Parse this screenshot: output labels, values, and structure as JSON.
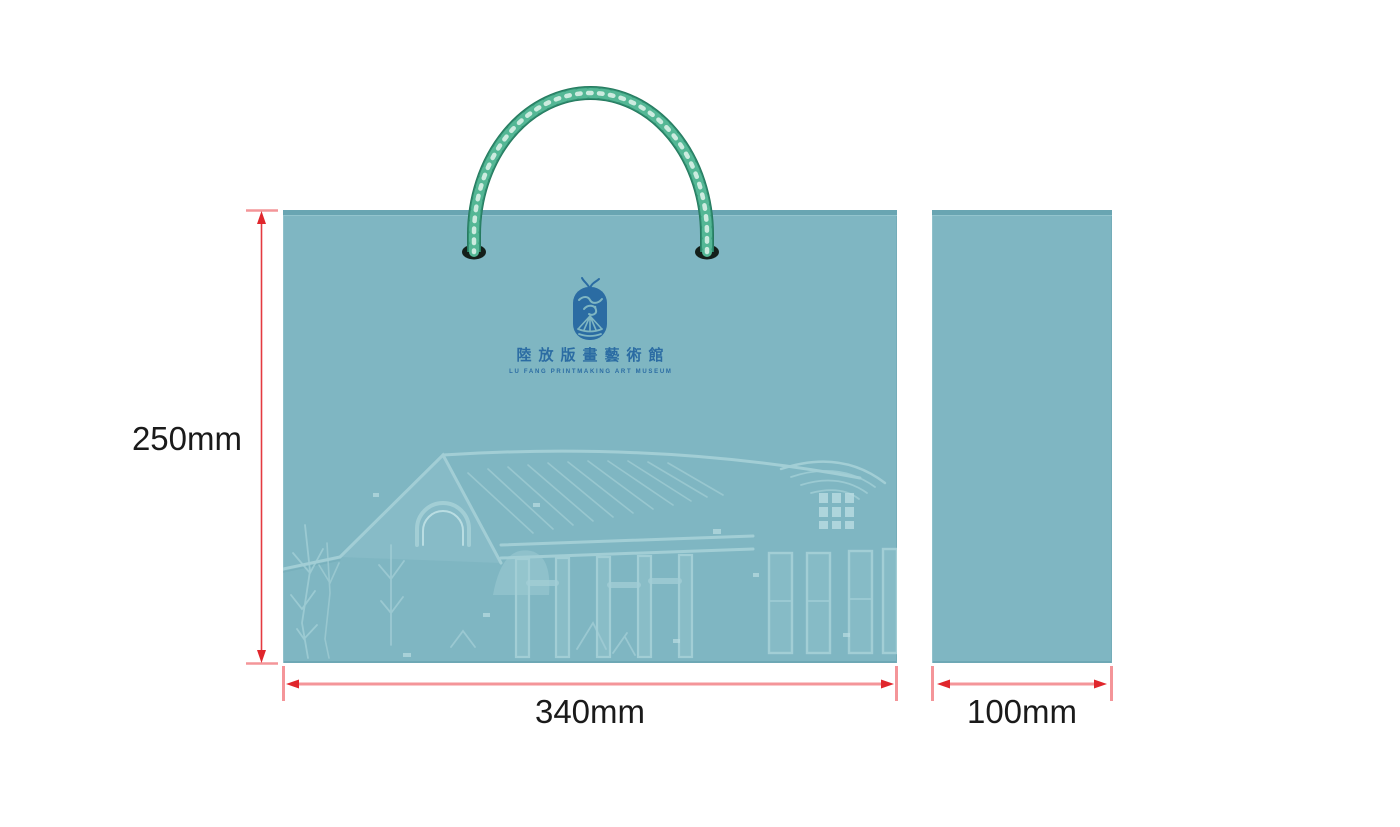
{
  "page": {
    "description": "Paper shopping bag packaging design mockup with dimension annotations",
    "background": "#ffffff"
  },
  "logo": {
    "chinese_name": "陸放版畫藝術館",
    "english_name": "LU FANG PRINTMAKING ART MUSEUM"
  },
  "dimensions": {
    "height_label": "250mm",
    "front_width_label": "340mm",
    "side_width_label": "100mm"
  },
  "icons": {
    "emblem": "museum-seal-emblem-icon",
    "handle": "twisted-rope-handle",
    "artwork": "embossed-building-relief"
  },
  "colors": {
    "bag_teal": "#7fb6c2",
    "bag_edge_dark": "#69a5b2",
    "emboss_light": "#a9d3d9",
    "logo_blue": "#2b6ca3",
    "rope_green": "#2f8e70",
    "rope_mid": "#54b795",
    "rope_highlight": "#d9f1e7",
    "dimension_red": "#e0262c",
    "dimension_pink": "#f49599",
    "label_color": "#1a1a1a"
  }
}
